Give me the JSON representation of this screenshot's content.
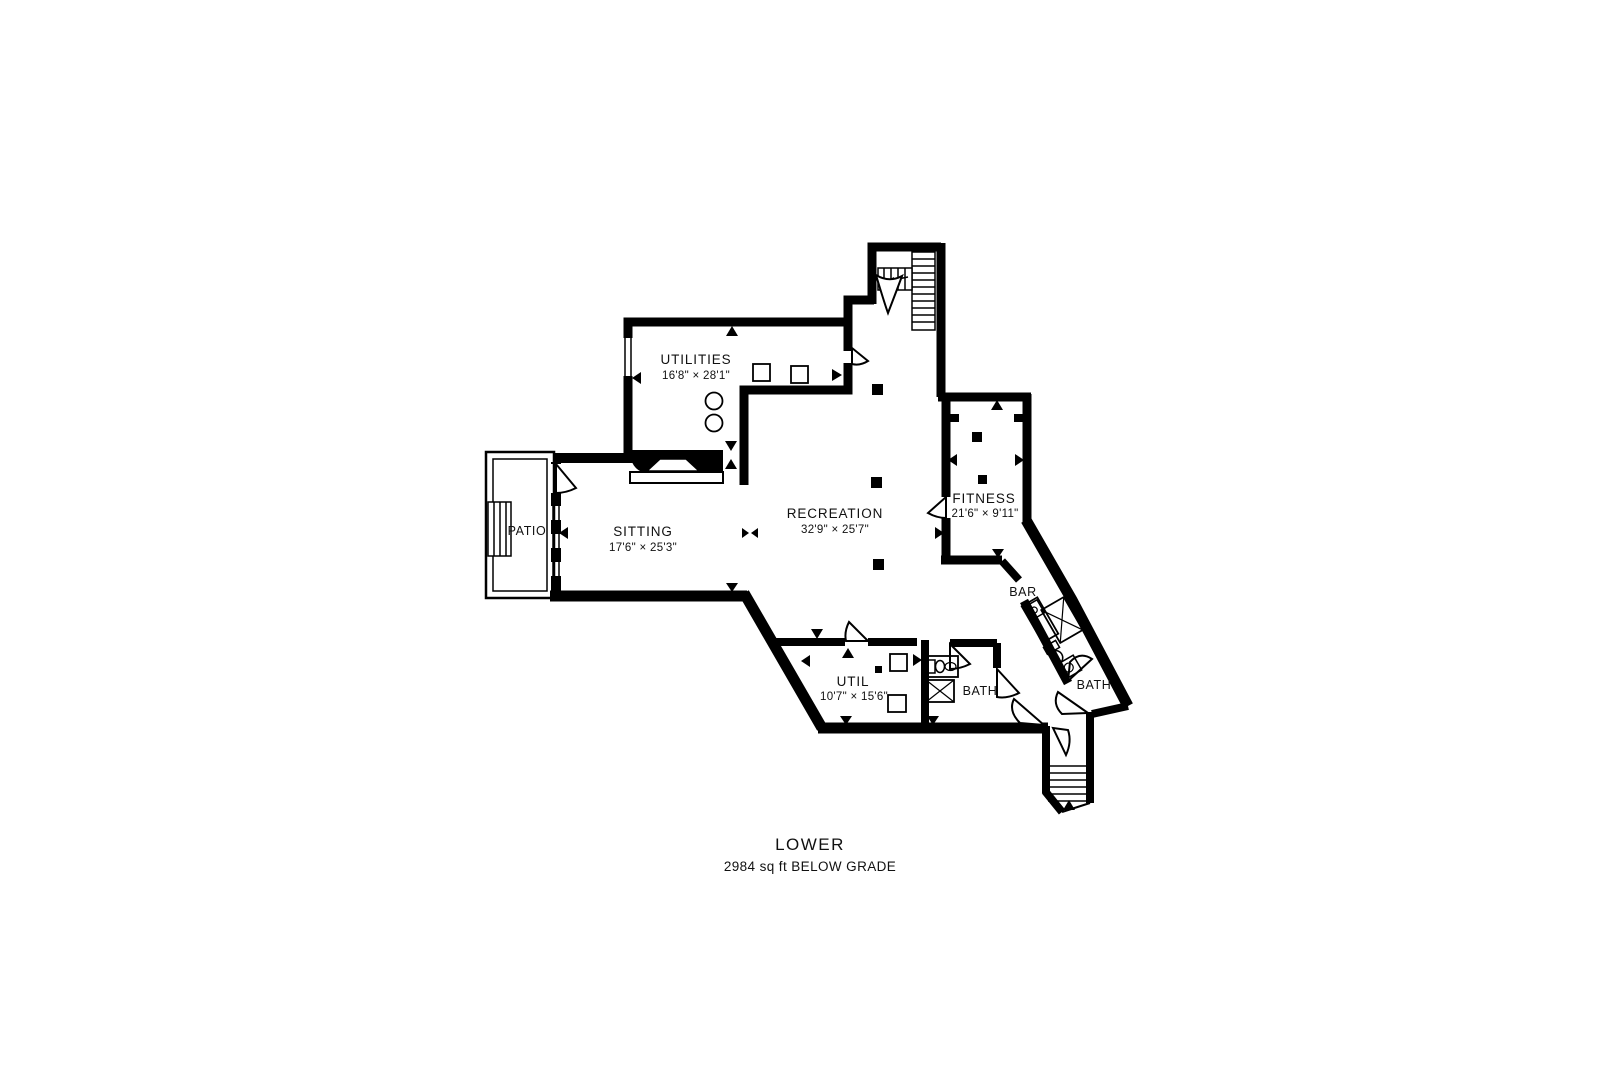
{
  "plan": {
    "caption": {
      "title": "LOWER",
      "subtitle": "2984 sq ft BELOW GRADE"
    },
    "rooms": [
      {
        "label": "UTILITIES",
        "dims": "16'8\" × 28'1\""
      },
      {
        "label": "RECREATION",
        "dims": "32'9\" × 25'7\""
      },
      {
        "label": "SITTING",
        "dims": "17'6\" × 25'3\""
      },
      {
        "label": "FITNESS",
        "dims": "21'6\" × 9'11\""
      },
      {
        "label": "UTIL",
        "dims": "10'7\" × 15'6\""
      },
      {
        "label": "PATIO"
      },
      {
        "label": "BAR"
      },
      {
        "label": "BATH"
      },
      {
        "label": "BATH"
      }
    ],
    "colors": {
      "walls": "#000000",
      "text": "#111111",
      "background": "#ffffff"
    },
    "icons": [
      "stairs-icon",
      "fireplace-icon",
      "shower-icon",
      "toilet-icon",
      "sink-icon",
      "door-swing-icon",
      "column-marker",
      "window-icon",
      "appliance-icon"
    ]
  }
}
